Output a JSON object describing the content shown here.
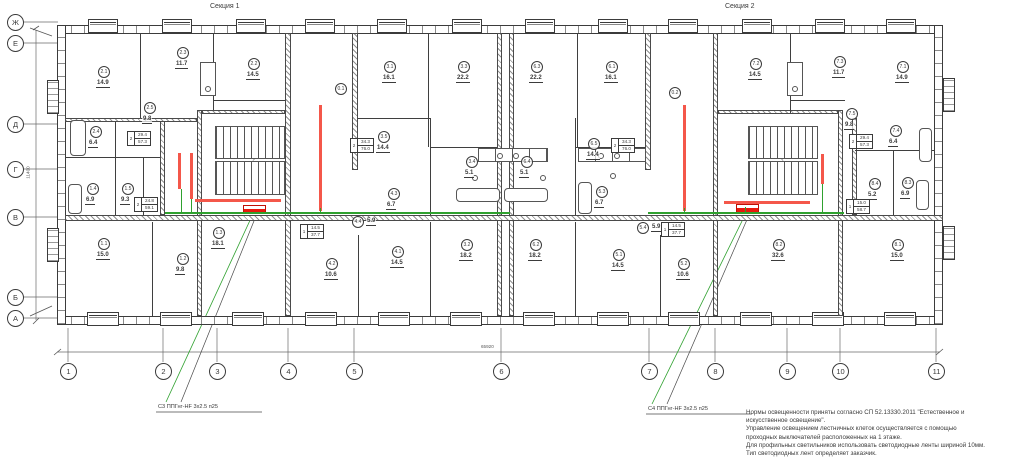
{
  "titles": {
    "section1": "Секция 1",
    "section2": "Секция 2"
  },
  "axes": {
    "left": [
      {
        "label": "Ж",
        "y": 22
      },
      {
        "label": "Е",
        "y": 43
      },
      {
        "label": "Д",
        "y": 124
      },
      {
        "label": "Г",
        "y": 169
      },
      {
        "label": "В",
        "y": 217
      },
      {
        "label": "Б",
        "y": 297
      },
      {
        "label": "А",
        "y": 318
      }
    ],
    "bottom": [
      {
        "label": "1",
        "x": 68
      },
      {
        "label": "2",
        "x": 163
      },
      {
        "label": "3",
        "x": 217
      },
      {
        "label": "4",
        "x": 288
      },
      {
        "label": "5",
        "x": 354
      },
      {
        "label": "6",
        "x": 501
      },
      {
        "label": "7",
        "x": 649
      },
      {
        "label": "8",
        "x": 715
      },
      {
        "label": "9",
        "x": 787
      },
      {
        "label": "10",
        "x": 840
      },
      {
        "label": "11",
        "x": 936
      }
    ],
    "width_dim": "65920",
    "height_dim": "11400"
  },
  "rooms": [
    {
      "id": "2.1",
      "area": "14.9",
      "x": 104,
      "y": 72
    },
    {
      "id": "2.3",
      "area": "11.7",
      "x": 183,
      "y": 53
    },
    {
      "id": "2.2",
      "area": "14.5",
      "x": 254,
      "y": 64
    },
    {
      "id": "2.5",
      "area": "9.8",
      "x": 150,
      "y": 108
    },
    {
      "id": "2.4",
      "area": "6.4",
      "x": 96,
      "y": 132
    },
    {
      "id": "1.4",
      "area": "6.9",
      "x": 93,
      "y": 189
    },
    {
      "id": "1.5",
      "area": "9.3",
      "x": 128,
      "y": 189
    },
    {
      "id": "1.1",
      "area": "15.0",
      "x": 104,
      "y": 244
    },
    {
      "id": "1.2",
      "area": "9.8",
      "x": 183,
      "y": 259
    },
    {
      "id": "1.3",
      "area": "18.1",
      "x": 219,
      "y": 233
    },
    {
      "id": "0.1",
      "area": "",
      "x": 341,
      "y": 89
    },
    {
      "id": "3.1",
      "area": "16.1",
      "x": 390,
      "y": 67
    },
    {
      "id": "3.3",
      "area": "22.2",
      "x": 464,
      "y": 67
    },
    {
      "id": "3.5",
      "area": "14.4",
      "x": 384,
      "y": 137
    },
    {
      "id": "3.4",
      "area": "5.1",
      "x": 472,
      "y": 162
    },
    {
      "id": "4.3",
      "area": "6.7",
      "x": 394,
      "y": 194
    },
    {
      "id": "4.4",
      "area": "5.9",
      "x": 358,
      "y": 222,
      "inline": true
    },
    {
      "id": "4.1",
      "area": "14.5",
      "x": 398,
      "y": 252
    },
    {
      "id": "4.2",
      "area": "10.6",
      "x": 332,
      "y": 264
    },
    {
      "id": "3.2",
      "area": "18.2",
      "x": 467,
      "y": 245
    },
    {
      "id": "6.3",
      "area": "22.2",
      "x": 537,
      "y": 67
    },
    {
      "id": "6.1",
      "area": "16.1",
      "x": 612,
      "y": 67
    },
    {
      "id": "6.4",
      "area": "5.1",
      "x": 527,
      "y": 162
    },
    {
      "id": "6.5",
      "area": "14.4",
      "x": 594,
      "y": 144
    },
    {
      "id": "5.3",
      "area": "6.7",
      "x": 602,
      "y": 192
    },
    {
      "id": "5.4",
      "area": "5.9",
      "x": 643,
      "y": 228,
      "inline": true
    },
    {
      "id": "5.1",
      "area": "14.5",
      "x": 619,
      "y": 255
    },
    {
      "id": "5.2",
      "area": "10.6",
      "x": 684,
      "y": 264
    },
    {
      "id": "6.2",
      "area": "18.2",
      "x": 536,
      "y": 245
    },
    {
      "id": "0.2",
      "area": "",
      "x": 675,
      "y": 93
    },
    {
      "id": "7.2",
      "area": "14.5",
      "x": 756,
      "y": 64
    },
    {
      "id": "7.3",
      "area": "11.7",
      "x": 840,
      "y": 62
    },
    {
      "id": "7.5",
      "area": "9.8",
      "x": 852,
      "y": 114
    },
    {
      "id": "7.1",
      "area": "14.9",
      "x": 903,
      "y": 67
    },
    {
      "id": "7.4",
      "area": "6.4",
      "x": 896,
      "y": 131
    },
    {
      "id": "8.2",
      "area": "32.6",
      "x": 779,
      "y": 245
    },
    {
      "id": "8.4",
      "area": "5.2",
      "x": 875,
      "y": 184
    },
    {
      "id": "8.3",
      "area": "6.9",
      "x": 908,
      "y": 183
    },
    {
      "id": "8.1",
      "area": "15.0",
      "x": 898,
      "y": 245
    }
  ],
  "apartment_tags": [
    {
      "num": "2",
      "living": "29.4",
      "total": "57.3",
      "x": 127,
      "y": 131
    },
    {
      "num": "2",
      "living": "24.8",
      "total": "59.1",
      "x": 134,
      "y": 197
    },
    {
      "num": "2",
      "living": "34.3",
      "total": "76.0",
      "x": 350,
      "y": 138
    },
    {
      "num": "1",
      "living": "14.5",
      "total": "37.7",
      "x": 300,
      "y": 224
    },
    {
      "num": "2",
      "living": "34.3",
      "total": "76.0",
      "x": 611,
      "y": 138
    },
    {
      "num": "1",
      "living": "14.5",
      "total": "37.7",
      "x": 661,
      "y": 222
    },
    {
      "num": "2",
      "living": "29.4",
      "total": "57.3",
      "x": 849,
      "y": 134
    },
    {
      "num": "1",
      "living": "15.0",
      "total": "58.7",
      "x": 846,
      "y": 199
    }
  ],
  "cable_labels": [
    {
      "text": "С3 ППГнг-HF 3х2.5 п25",
      "x": 158,
      "y": 404
    },
    {
      "text": "С4 ППГнг-HF 3х2.5 п25",
      "x": 648,
      "y": 406
    }
  ],
  "notes": [
    "Нормы освещенности приняты согласно СП 52.13330.2011 \"Естественное и",
    "искусственное освещение\".",
    "Управление освещением лестничных клеток осуществляется с помощью",
    "проходных выключателей расположенных на 1 этаже.",
    "Для профильных светильников использовать светодиодные ленты шириной 10мм.",
    "Тип светодиодных лент определяет заказчик."
  ],
  "colors": {
    "led_strip": "#f4574a",
    "luminaire": "#e8190c",
    "wire": "#2fa12f",
    "line": "#3b3b3b"
  }
}
